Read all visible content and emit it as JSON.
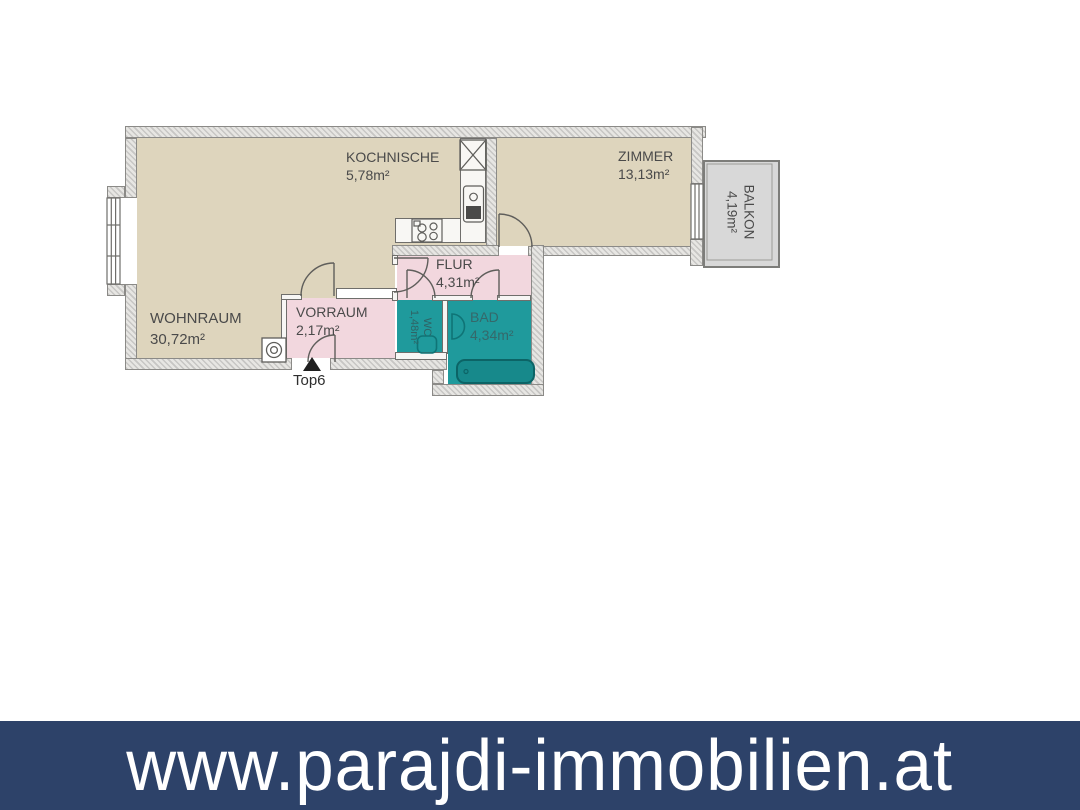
{
  "footer": {
    "url": "www.parajdi-immobilien.at"
  },
  "entrance": {
    "label": "Top6"
  },
  "rooms": {
    "wohnraum": {
      "name": "WOHNRAUM",
      "area": "30,72m²"
    },
    "kochnische": {
      "name": "KOCHNISCHE",
      "area": "5,78m²"
    },
    "zimmer": {
      "name": "ZIMMER",
      "area": "13,13m²"
    },
    "balkon": {
      "name": "BALKON",
      "area": "4,19m²"
    },
    "flur": {
      "name": "FLUR",
      "area": "4,31m²"
    },
    "vorraum": {
      "name": "VORRAUM",
      "area": "2,17m²"
    },
    "wc": {
      "name": "WC",
      "area": "1,48m²"
    },
    "bad": {
      "name": "BAD",
      "area": "4,34m²"
    }
  },
  "colors": {
    "room_beige": "#ded5bd",
    "room_pink": "#f2d7de",
    "room_teal": "#1f9a9c",
    "balkon_gray": "#d8d8d8",
    "banner_blue": "#2d4269",
    "text_dark": "#4a4a4a",
    "fixture_teal": "#0f7476",
    "tub_teal": "#17898b"
  }
}
